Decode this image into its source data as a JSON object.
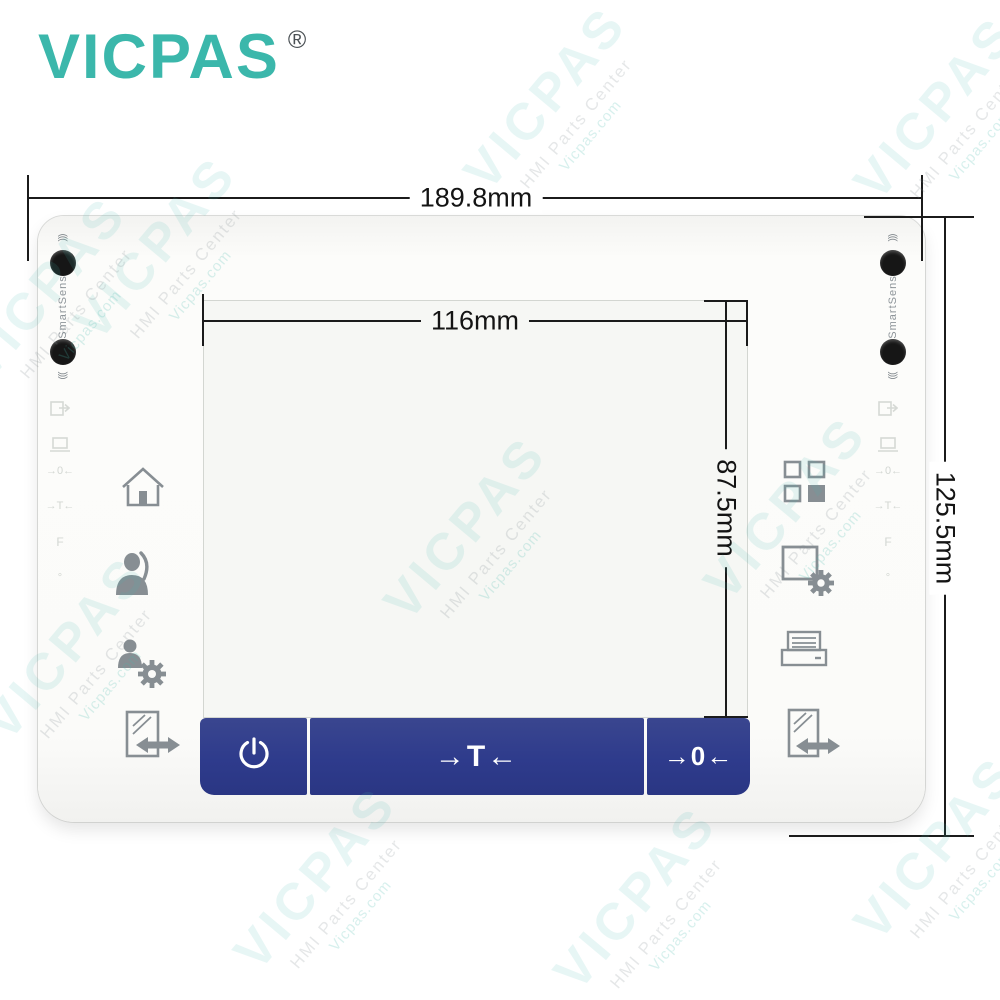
{
  "brand": {
    "logo_text": "VICPAS",
    "registered_mark": "®",
    "logo_color": "#3bb7ab"
  },
  "watermark": {
    "primary": "VICPAS",
    "secondary": "HMI Parts Center",
    "tertiary": "Vicpas.com"
  },
  "annotations": {
    "overall_width": "189.8mm",
    "screen_width": "116mm",
    "screen_height": "87.5mm",
    "overall_height": "125.5mm"
  },
  "panel": {
    "sensor": {
      "label": "SmartSens",
      "wave_top": ")))",
      "wave_bottom": "((("
    },
    "left_icon_names": [
      "home-icon",
      "user-icon",
      "user-settings-icon",
      "document-transfer-icon"
    ],
    "right_icon_names": [
      "app-grid-icon",
      "display-settings-icon",
      "printer-icon",
      "document-transfer-icon"
    ],
    "embossed": {
      "zero": "→0←",
      "tare": "→T←",
      "f": "F",
      "degree": "°"
    },
    "buttons": {
      "tare_label": "→T←",
      "zero_label": "→0←",
      "bar_color": "#2e3b8c"
    }
  },
  "colors": {
    "panel_bg": "#fbfbf9",
    "screen_bg": "#f6f7f4",
    "icon_gray": "#878e93",
    "dimension_line": "#1b1b1b",
    "sensor_dot": "#161616"
  }
}
